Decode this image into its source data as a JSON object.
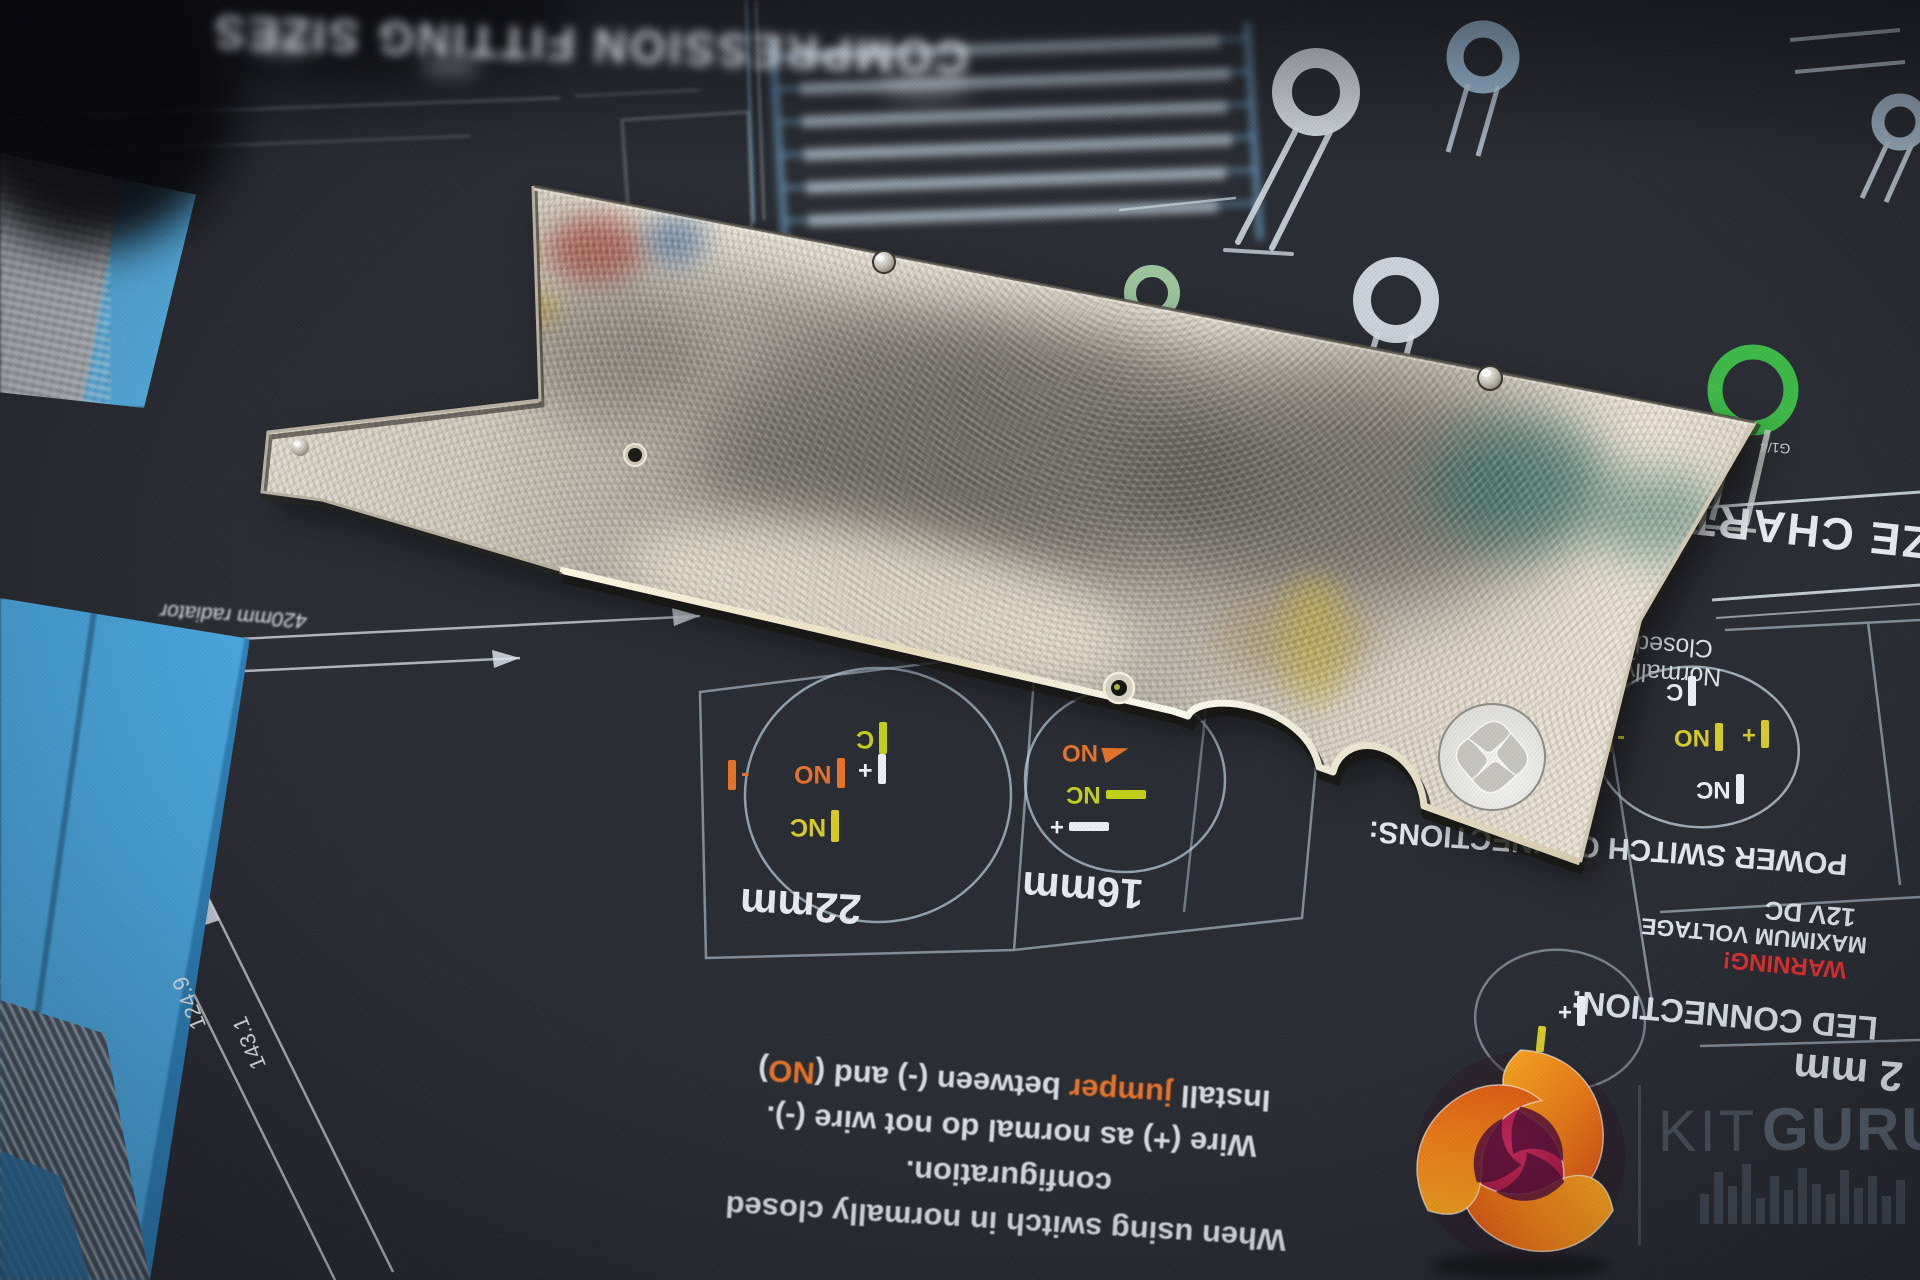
{
  "colors": {
    "mat_base": "#292c32",
    "mat_line": "#cfdbe6",
    "blue": "#5fb0e5",
    "table_blue": "#6fa8d4",
    "orange": "#e8732a",
    "yellow": "#d8cc28",
    "yellow_green": "#bccf1e",
    "green": "#3fc24a",
    "pale_green": "#a8d8aa",
    "red": "#e03030",
    "plate_light": "#efe9da",
    "plate_dark": "#7e7a72",
    "watermark_gray": "#6c7a8a"
  },
  "mat": {
    "top_heading": "COMPRESSION FITTING SIZES",
    "size_chart": "ZE CHART",
    "radiator_label": "420mm radiator",
    "dim_a": "143.1",
    "dim_b": "124.9",
    "fitting_thread": "G1/4",
    "tube_22": "22mm",
    "tube_16": "16mm",
    "switch_panel": {
      "heading1": "Normally",
      "heading2": "Closed",
      "title": "POWER SWITCH CONNECTIONS:"
    },
    "led_panel": {
      "voltage": "12V DC",
      "voltage_label": "MAXIMUM VOLTAGE",
      "warning": "WARNING!",
      "title": "LED CONNECTION:",
      "size": "2 mm"
    },
    "terminals": {
      "c": "C",
      "no": "NO",
      "nc": "NC",
      "plus": "+",
      "minus": "-"
    },
    "instructions": {
      "line1": "When using switch in normally closed",
      "line2": "configuration.",
      "line3": "Wire (+) as normal do not wire (-).",
      "line4a": "Install ",
      "line4b": "jumper",
      "line4c": " between (-) and (",
      "line4d": "NO",
      "line4e": ")"
    }
  },
  "watermark": {
    "kit": "KIT",
    "guru": "GURU"
  }
}
